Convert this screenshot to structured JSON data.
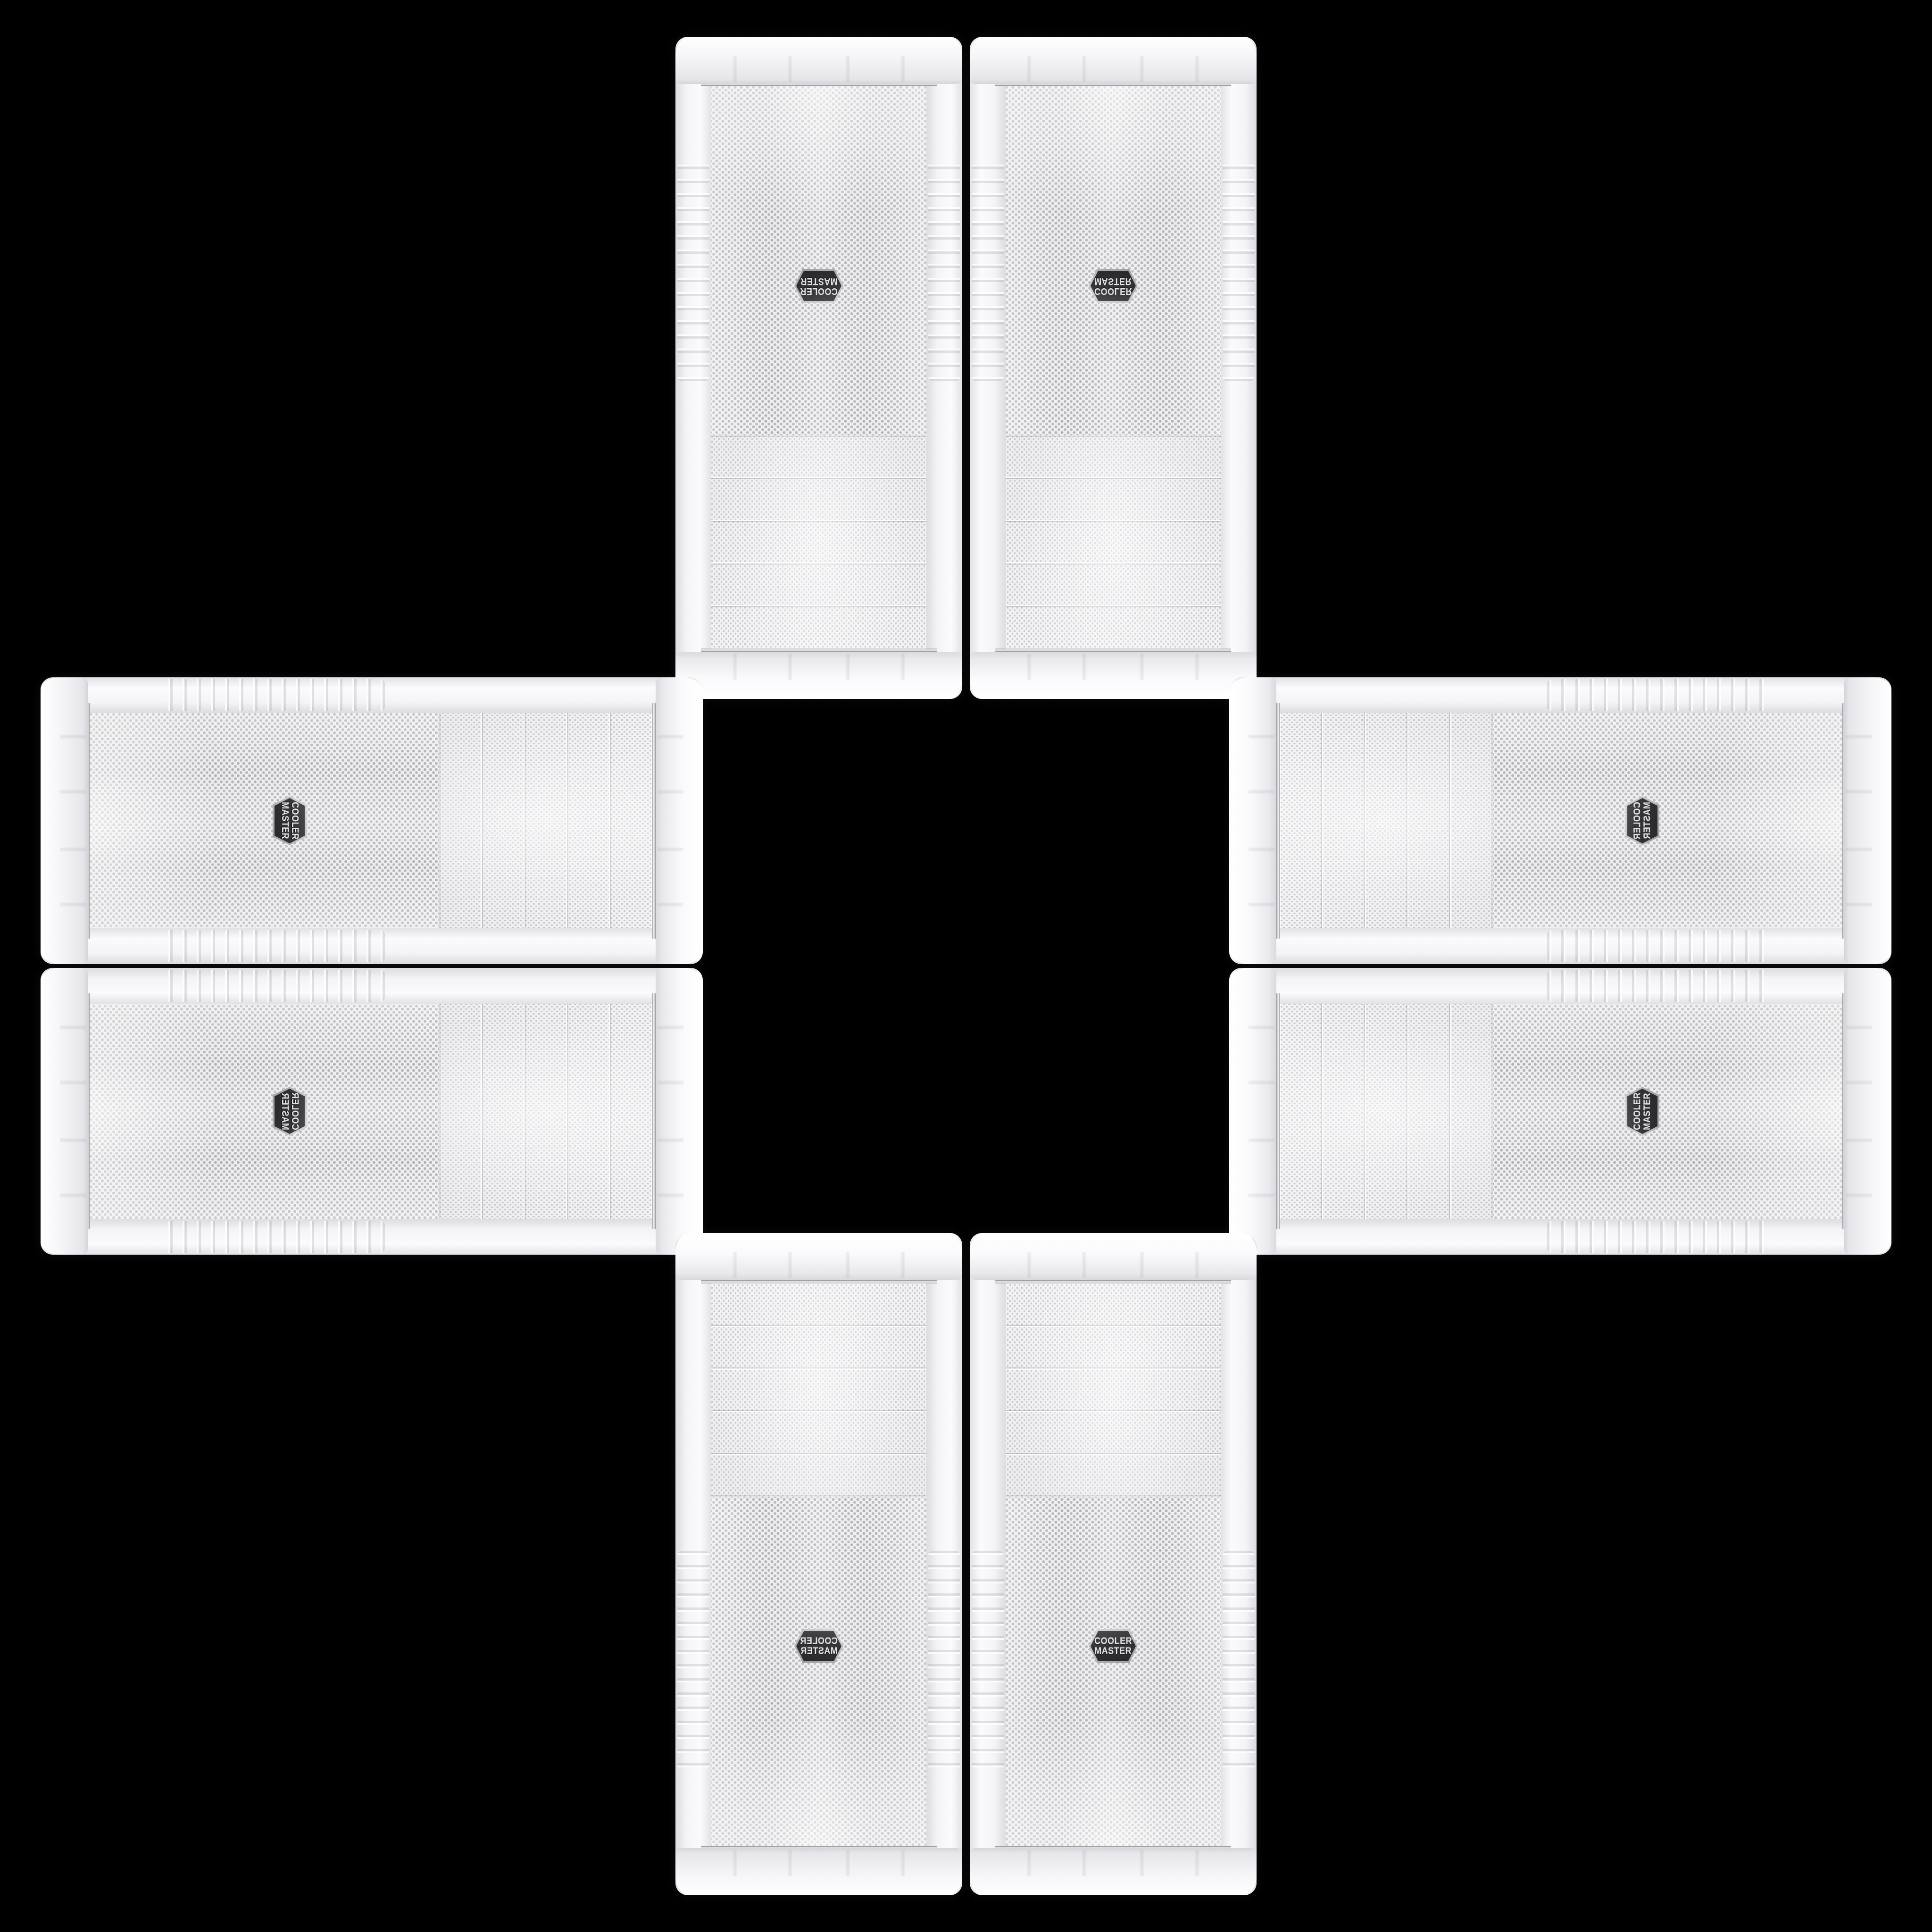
{
  "scene": {
    "description": "Eight identical white Cooler Master PC tower case front panels arranged in a plus (cross) pattern on a black background, mirrored and rotated around an empty black center square",
    "background_color": "#000000",
    "case_count": 8
  },
  "badge": {
    "line1": "COOLER",
    "line2": "MASTER",
    "shape": "hexagon",
    "background_color": "#343437",
    "text_color": "#e3e3e6"
  },
  "palette": {
    "case_body": "#f2f2f4",
    "cap_highlight": "#ffffff",
    "cap_shadow": "#d9d9de",
    "mesh_background": "#efeff1",
    "mesh_dot_small": "#c6c6ca",
    "mesh_dot_large": "#b4b4b8",
    "chrome_trim": "#d7d7db",
    "flare_ribs": "#e2e2e6"
  },
  "cases": [
    {
      "id": "top-left",
      "orientation": "vertical",
      "variant": "rotated-180"
    },
    {
      "id": "top-right",
      "orientation": "vertical",
      "variant": "flipped-vertical"
    },
    {
      "id": "left-upper",
      "orientation": "horizontal",
      "variant": "rotated-90-cw"
    },
    {
      "id": "left-lower",
      "orientation": "horizontal",
      "variant": "rotated-90-cw-flipped"
    },
    {
      "id": "right-upper",
      "orientation": "horizontal",
      "variant": "rotated-90-ccw-flipped"
    },
    {
      "id": "right-lower",
      "orientation": "horizontal",
      "variant": "rotated-90-ccw"
    },
    {
      "id": "bottom-left",
      "orientation": "vertical",
      "variant": "flipped-horizontal"
    },
    {
      "id": "bottom-right",
      "orientation": "vertical",
      "variant": "upright"
    }
  ]
}
